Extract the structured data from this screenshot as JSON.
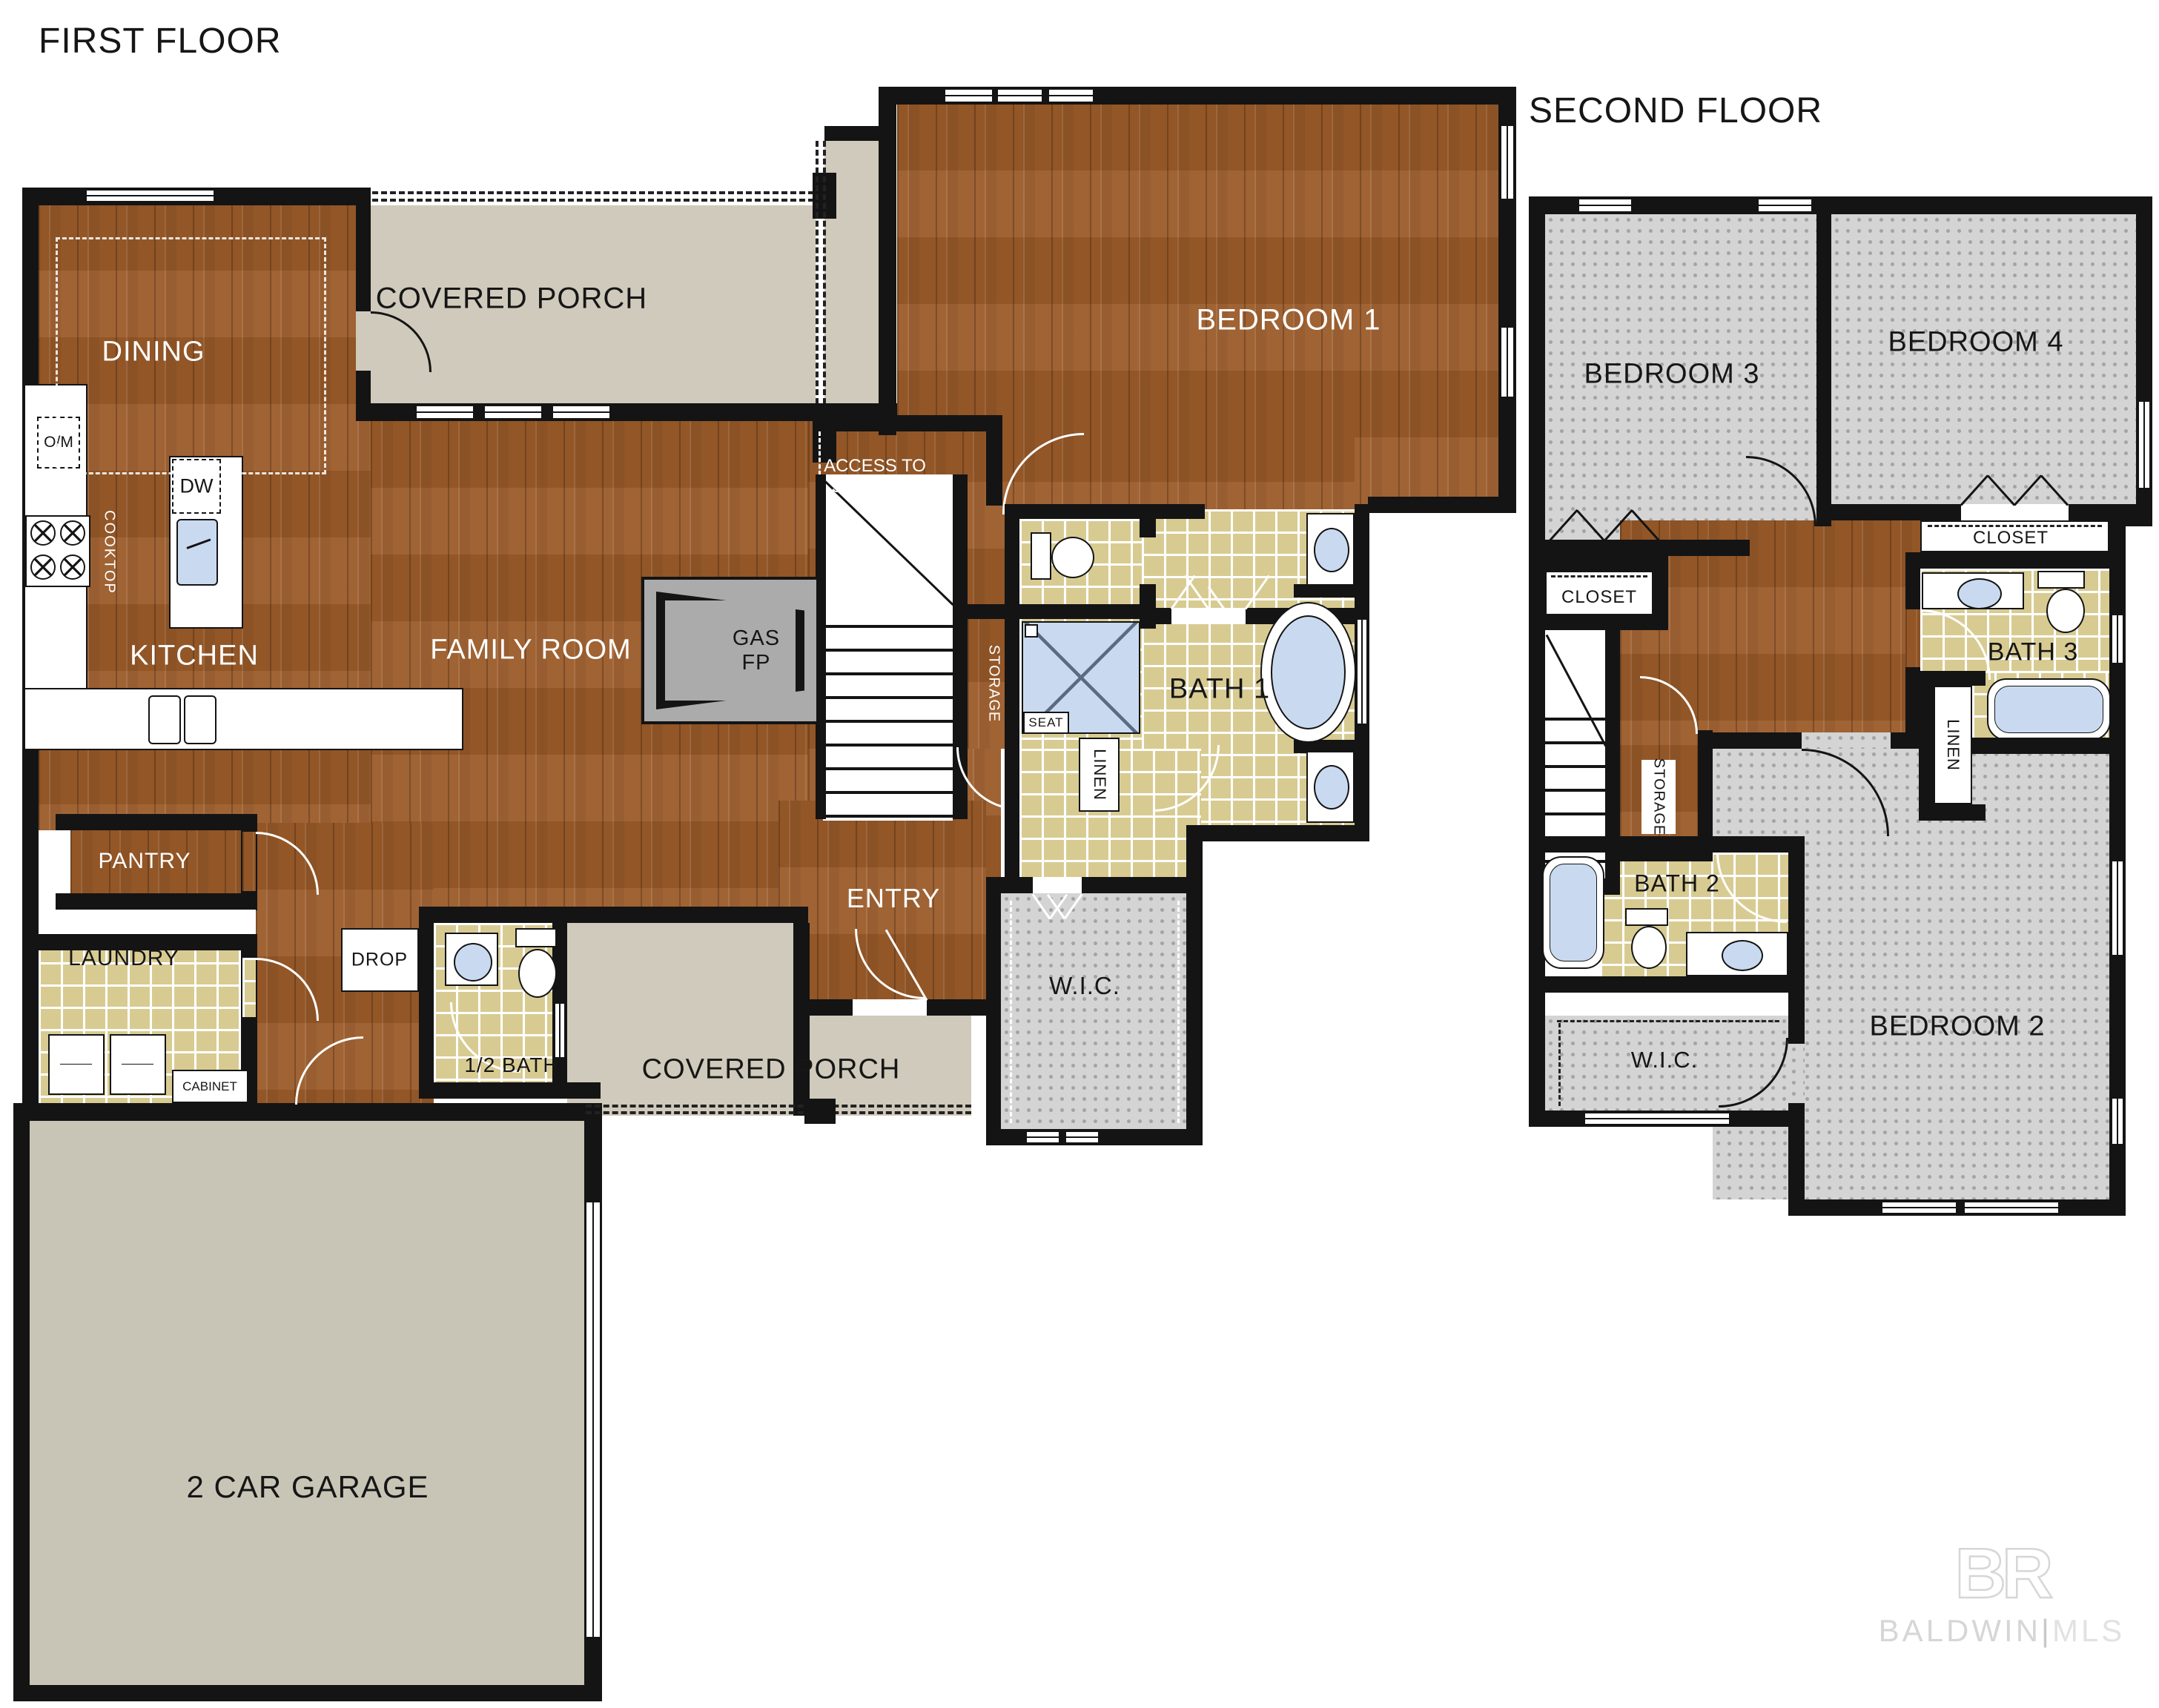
{
  "titles": {
    "first": "FIRST FLOOR",
    "second": "SECOND FLOOR"
  },
  "first_floor": {
    "dining": "DINING",
    "covered_porch_top": "COVERED PORCH",
    "bedroom1": "BEDROOM 1",
    "kitchen": "KITCHEN",
    "family_room": "FAMILY ROOM",
    "gas_fp": "GAS\nFP",
    "access_storage": "ACCESS TO\nSTORAGE",
    "storage": "STORAGE",
    "seat": "SEAT",
    "bath1": "BATH 1",
    "linen": "LINEN",
    "entry": "ENTRY",
    "wic": "W.I.C.",
    "pantry": "PANTRY",
    "laundry": "LAUNDRY",
    "cabinet": "CABINET",
    "drop": "DROP",
    "half_bath": "1/2 BATH",
    "covered_porch_bottom": "COVERED PORCH",
    "garage": "2 CAR GARAGE",
    "om": "O/M",
    "cooktop": "COOKTOP",
    "dw": "DW"
  },
  "second_floor": {
    "bedroom3": "BEDROOM 3",
    "bedroom4": "BEDROOM 4",
    "closet_left": "CLOSET",
    "closet_right": "CLOSET",
    "bath3": "BATH 3",
    "storage": "STORAGE",
    "linen": "LINEN",
    "bath2": "BATH 2",
    "wic": "W.I.C.",
    "bedroom2": "BEDROOM 2"
  },
  "watermark": {
    "logo": "BR",
    "brand": "BALDWIN",
    "divider": "|",
    "suffix": "MLS"
  },
  "colors": {
    "wall": "#141414",
    "wood": "#9b5b29",
    "tile": "#d8cb92",
    "carpet": "#d4d4d4",
    "porch": "#cfcabb",
    "garage": "#c9c5b6",
    "fixture_blue": "#c9daf0",
    "fp_gray": "#ababab"
  }
}
